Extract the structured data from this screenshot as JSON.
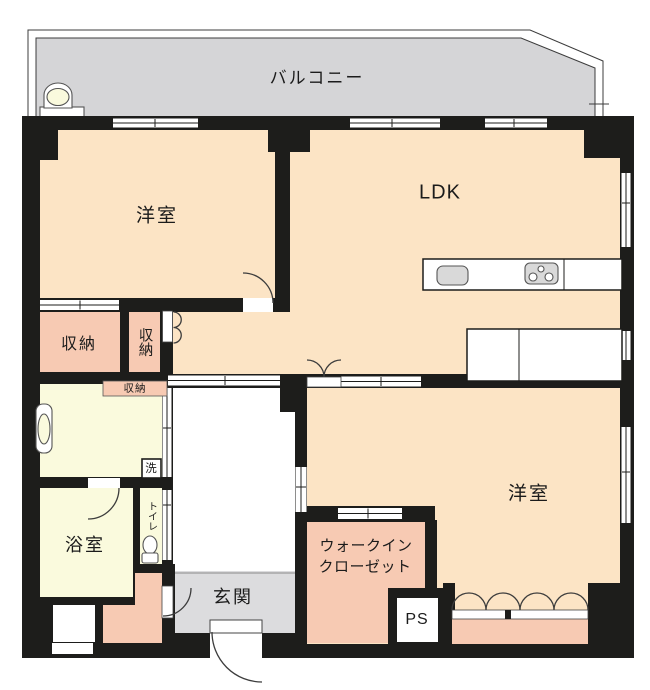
{
  "plan": {
    "title": "apartment-floor-plan",
    "rooms": {
      "balcony": {
        "label": "バルコニー"
      },
      "bedroom1": {
        "label": "洋室"
      },
      "ldk": {
        "label": "LDK"
      },
      "storage1": {
        "label": "収納"
      },
      "storage2": {
        "label": "収納"
      },
      "washroom_storage": {
        "label": "収納"
      },
      "laundry": {
        "label": "洗"
      },
      "bathroom": {
        "label": "浴室"
      },
      "toilet": {
        "label": "トイレ"
      },
      "entrance": {
        "label": "玄関"
      },
      "wic": {
        "line1": "ウォークイン",
        "line2": "クローゼット"
      },
      "ps": {
        "label": "PS"
      },
      "bedroom2": {
        "label": "洋室"
      }
    },
    "colors": {
      "wall": "#1d1d1b",
      "room_peach": "#fce4c5",
      "closet_pink": "#f7cab3",
      "wet_yellow": "#fafadd",
      "balcony_gray": "#d5d5d7",
      "entrance_gray": "#dcdcde",
      "counter_gray": "#d9d9d9",
      "line_dark": "#3c3c3c"
    }
  }
}
